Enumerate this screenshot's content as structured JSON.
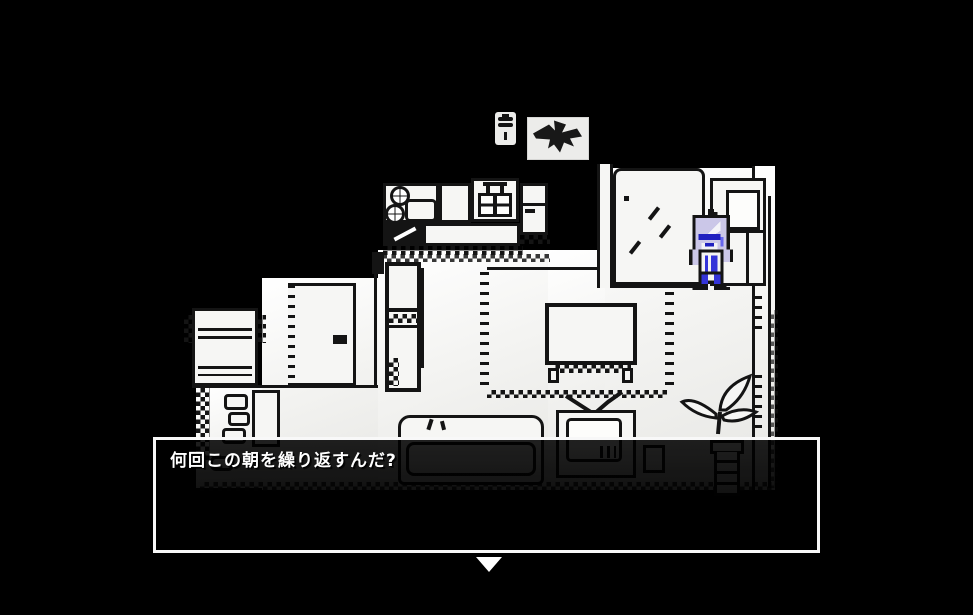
{
  "scene": {
    "colors": {
      "outline": "#141414",
      "paper": "#f6f6f4",
      "hair": "#cbc7e8",
      "accent_blue": "#3434d8",
      "deep_blue": "#2020c0",
      "dialog_border": "#f8f8f8",
      "text": "#ffffff",
      "panel": "#ececea"
    }
  },
  "hud": {
    "hanging_lamp_icon": "hanging-lamp",
    "crow_icon": "flying-crow"
  },
  "dialogue": {
    "text": "何回この朝を繰り返すんだ?",
    "continue_symbol": "▼"
  }
}
